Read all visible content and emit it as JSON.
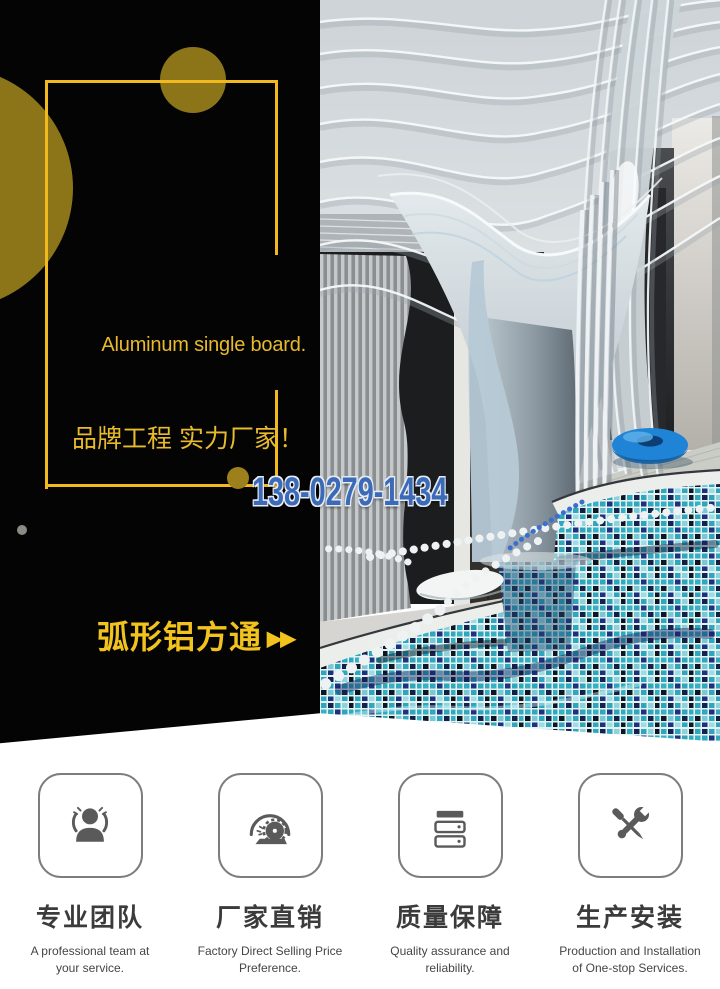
{
  "banner": {
    "headline_en": "Aluminum single board.",
    "headline_cn": "品牌工程 实力厂家！",
    "phone": "138-0279-1434",
    "product_name": "弧形铝方通",
    "product_arrows": "▶▶"
  },
  "colors": {
    "panel_black": "#040404",
    "gold_frame": "#f2b91f",
    "gold_circle": "#8c7519",
    "gold_text": "#e8ba2c",
    "product_gold": "#f3c31d",
    "phone_blue": "#3a6ab8",
    "phone_outline": "#e7ecf4",
    "pool_teal": "#2ea7bc",
    "pool_navy": "#1c3180",
    "ring_blue": "#1f83d6",
    "icon_gray": "#5a5a5a"
  },
  "features": [
    {
      "icon": "team-icon",
      "title": "专业团队",
      "desc": "A professional team at\nyour service."
    },
    {
      "icon": "saw-icon",
      "title": "厂家直销",
      "desc": "Factory Direct Selling Price\nPreference."
    },
    {
      "icon": "server-icon",
      "title": "质量保障",
      "desc": "Quality assurance and\nreliability."
    },
    {
      "icon": "tools-icon",
      "title": "生产安装",
      "desc": "Production and Installation\nof One-stop Services."
    }
  ]
}
